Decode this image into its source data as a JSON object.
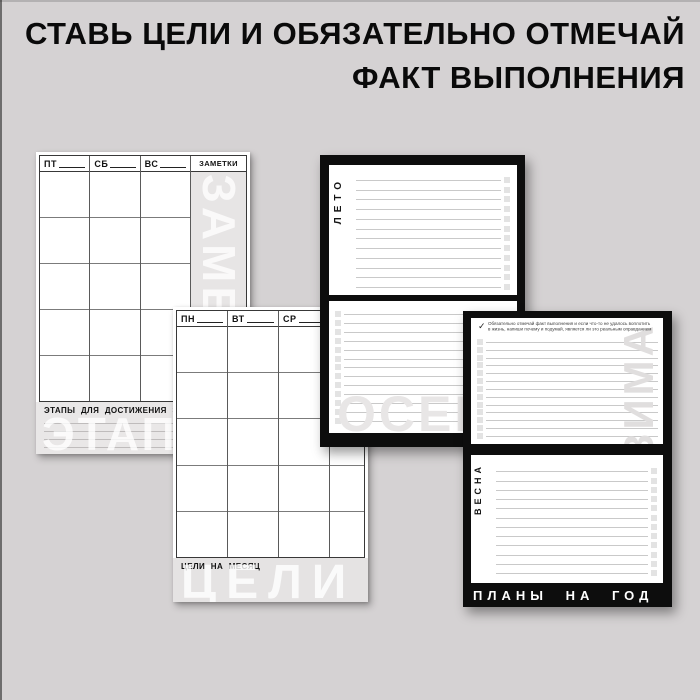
{
  "title": {
    "line1": "СТАВЬ ЦЕЛИ И ОБЯЗАТЕЛЬНО ОТМЕЧАЙ",
    "line2": "ФАКТ ВЫПОЛНЕНИЯ"
  },
  "pages": {
    "weekend_spread": {
      "day_headers": [
        "ПТ",
        "СБ",
        "ВС"
      ],
      "grid_rows": 5,
      "notes_header": "ЗАМЕТКИ",
      "notes_watermark": "ЗАМЕТКИ",
      "footer_title": "ЭТАПЫ ДЛЯ ДОСТИЖЕНИЯ ЭТОЙ ЦЕЛИ",
      "footer_watermark": "ЭТАПЫ",
      "footer_lines": 4
    },
    "weekday_spread": {
      "day_headers": [
        "ПН",
        "ВТ",
        "СР"
      ],
      "grid_rows": 5,
      "footer_title": "ЦЕЛИ НА МЕСЯЦ",
      "footer_watermark": "ЦЕЛИ"
    },
    "summer_autumn": {
      "summer": {
        "label": "ЛЕТО",
        "lines": 12,
        "checkbox_side": "right"
      },
      "autumn": {
        "watermark": "ОСЕНЬ",
        "lines": 13,
        "checkbox_side": "left"
      }
    },
    "winter_spring": {
      "note_check": "✓",
      "note_line1": "Обязательно отмечай факт выполнения и если что-то не удалось воплотить",
      "note_line2": "в жизнь, напиши почему и подумай, является ли это реальным оправданием",
      "winter": {
        "watermark": "ЗИМА",
        "lines": 13,
        "checkbox_side": "left"
      },
      "spring": {
        "label": "ВЕСНА",
        "lines": 12,
        "checkbox_side": "right"
      },
      "footer": "ПЛАНЫ НА ГОД"
    }
  },
  "colors": {
    "background": "#d5d2d3",
    "title_text": "#0a0a0a",
    "page_frame_black": "#0d0d0d",
    "page_white": "#ffffff",
    "notes_column_gray": "#e7e5e5",
    "footer_band_gray": "#e9e7e7",
    "ruled_line": "#c9c9c9",
    "checkbox_fill": "#e3e3e3",
    "grid_outer_border": "#383838",
    "grid_row_line": "#7b7b7b",
    "watermark_white": "rgba(255,255,255,0.78)",
    "watermark_light_gray": "#e0dede"
  }
}
